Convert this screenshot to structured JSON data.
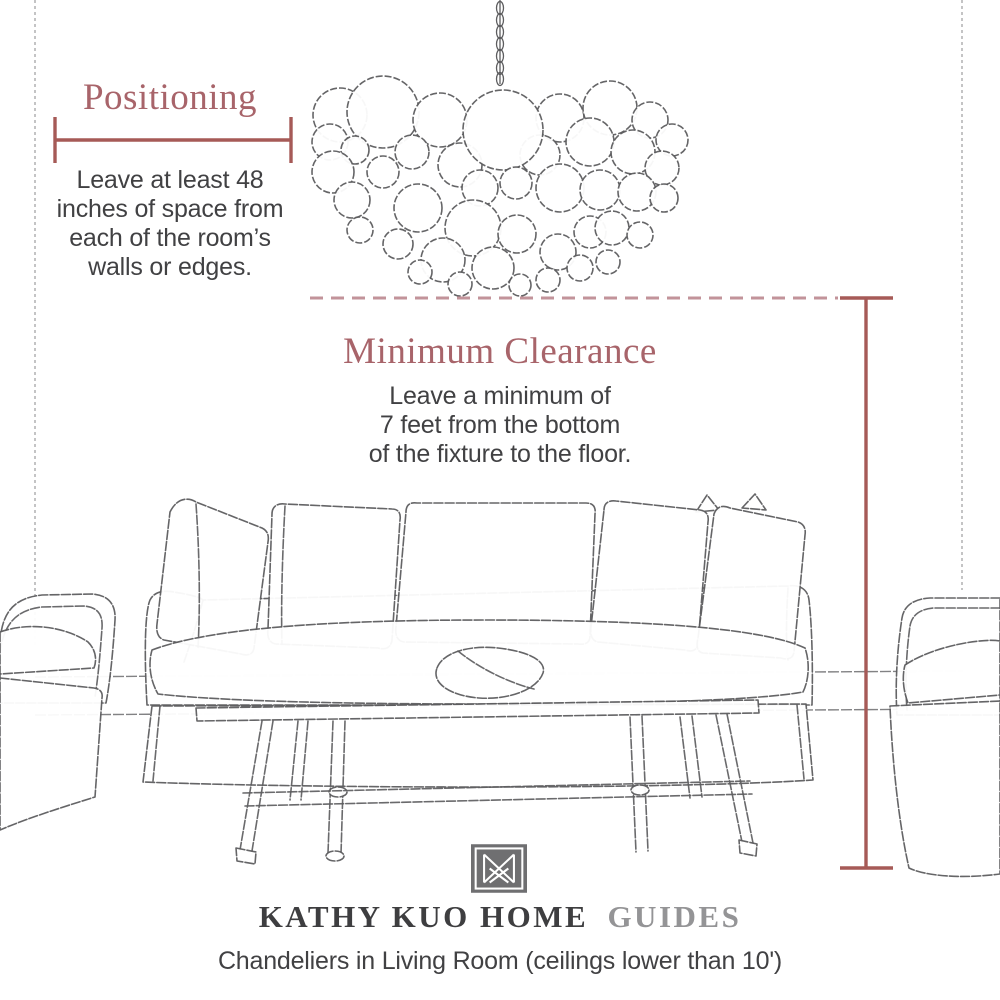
{
  "colors": {
    "accent": "#a8646a",
    "measure": "#a65a57",
    "dashed": "#c2939a",
    "sketch": "#5d5d5f",
    "text": "#414143",
    "wall": "#8e8e90",
    "brandDark": "#3e3e40",
    "brandLight": "#949496",
    "logoBg": "#6f6f71"
  },
  "positioning_section": {
    "title": "Positioning",
    "body": "Leave at least 48\ninches of space from\neach of the room’s\nwalls or edges."
  },
  "clearance_section": {
    "title": "Minimum Clearance",
    "body": "Leave a minimum of\n7 feet from the bottom\nof the fixture to the floor."
  },
  "footer": {
    "brand_main": "KATHY KUO HOME",
    "brand_suffix": "GUIDES",
    "caption": "Chandeliers in Living Room (ceilings lower than 10')"
  },
  "icons": {
    "logo": "kk-monogram-icon"
  }
}
